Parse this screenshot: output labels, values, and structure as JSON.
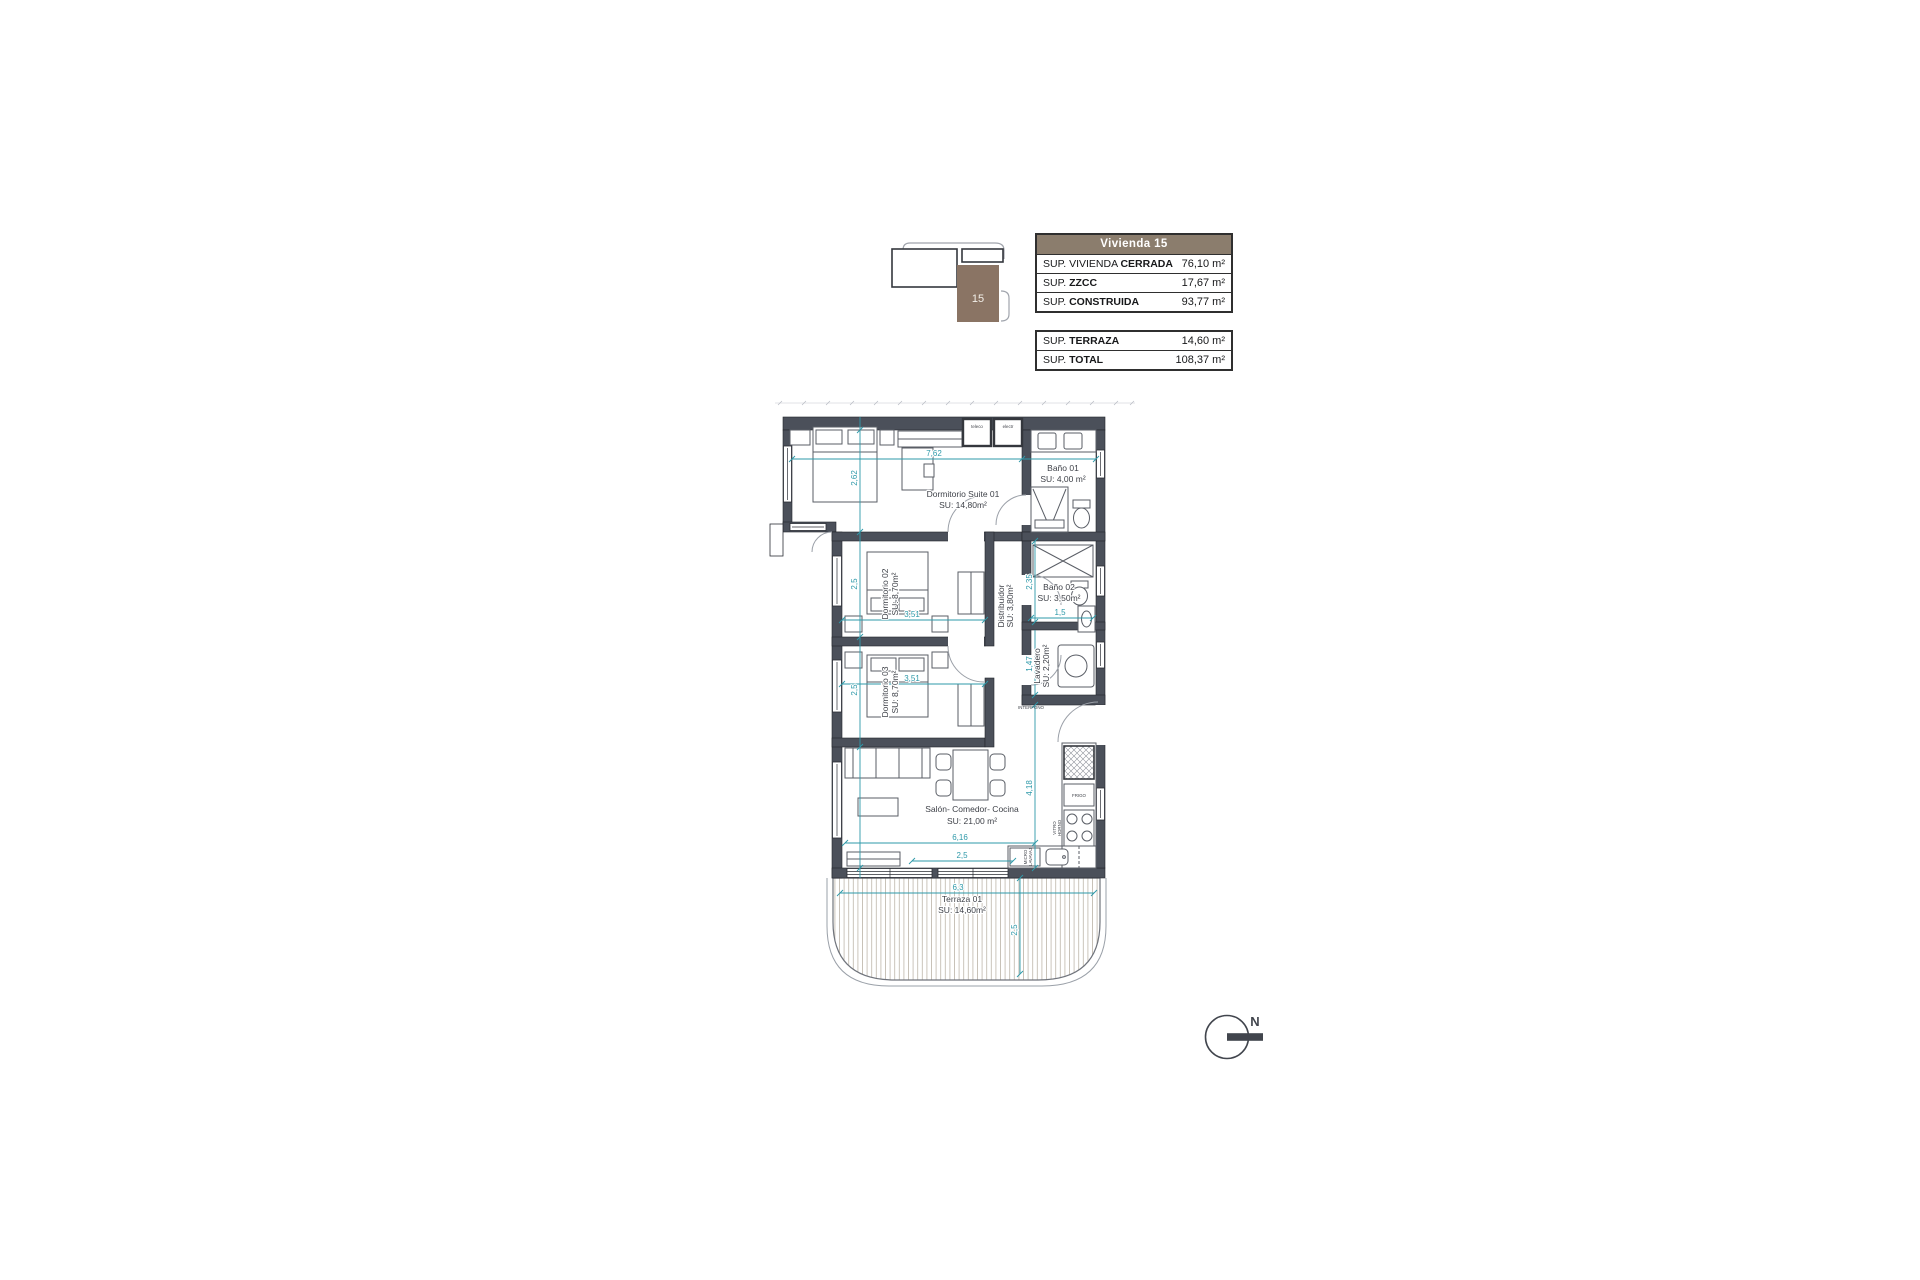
{
  "key_plan": {
    "unit": "15"
  },
  "area_table": {
    "header": "Vivienda 15",
    "rows": [
      {
        "prefix": "SUP. VIVIENDA ",
        "bold": "CERRADA",
        "value": "76,10 m²"
      },
      {
        "prefix": "SUP. ",
        "bold": "ZZCC",
        "value": "17,67 m²"
      },
      {
        "prefix": "SUP. ",
        "bold": "CONSTRUIDA",
        "value": "93,77 m²"
      }
    ]
  },
  "totals_table": {
    "rows": [
      {
        "prefix": "SUP. ",
        "bold": "TERRAZA",
        "value": "14,60 m²"
      },
      {
        "prefix": "SUP. ",
        "bold": "TOTAL",
        "value": "108,37 m²"
      }
    ]
  },
  "plan": {
    "rooms": {
      "suite": {
        "name": "Dormitorio Suite 01",
        "area": "SU: 14,80m²"
      },
      "bano1": {
        "name": "Baño 01",
        "area": "SU: 4,00 m²"
      },
      "dorm2": {
        "name": "Dormitorio 02",
        "area": "SU: 8,70m²"
      },
      "dorm3": {
        "name": "Dormitorio 03",
        "area": "SU: 8,70m²"
      },
      "distribuidor": {
        "name": "Distribuidor",
        "area": "SU: 3,80m²"
      },
      "bano2": {
        "name": "Baño 02",
        "area": "SU: 3,50m²"
      },
      "lavadero": {
        "name": "Lavadero",
        "area": "SU: 2,20m²"
      },
      "salon": {
        "name": "Salón- Comedor- Cocina",
        "area": "SU: 21,00 m²"
      },
      "terraza": {
        "name": "Terraza 01",
        "area": "SU: 14,60m²"
      }
    },
    "dims": {
      "suite_w": "7,62",
      "suite_h": "2,62",
      "dorm2_w": "3,51",
      "dorm2_h": "2,5",
      "dorm3_w": "3,51",
      "dorm3_h": "2,5",
      "bano2_h": "2,35",
      "bano2_w": "1,5",
      "lavadero_h": "1,47",
      "salon_w": "6,16",
      "salon_w2": "2,5",
      "salon_h": "4,18",
      "terraza_w": "6,3",
      "terraza_h": "2,5"
    },
    "fixtures": {
      "teleco": "teleco",
      "electr": "electr",
      "interfono": "INTERFONO",
      "frigo": "FRIGO",
      "vitro": "VITRO",
      "horno": "HORNO",
      "micro": "MICRO",
      "lavavaj": "LAVAVAJ"
    }
  },
  "north": {
    "label": "N"
  },
  "colors": {
    "wall": "#4b505a",
    "dimension": "#2e99a9",
    "table_header_brown": "#8b7d6d",
    "key_unit_brown": "#8a7464",
    "label_text": "#3f4249"
  }
}
